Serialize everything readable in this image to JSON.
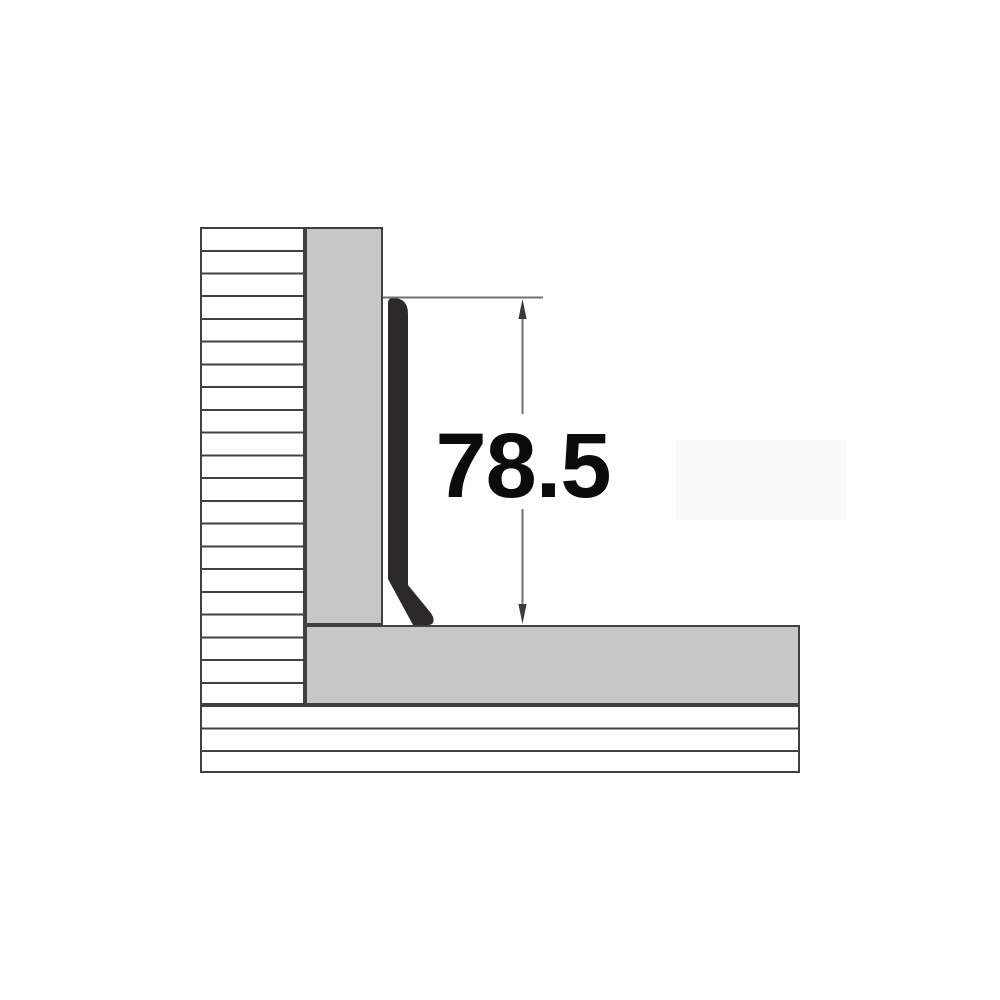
{
  "diagram": {
    "dimension_label": "78.5",
    "colors": {
      "background": "#ffffff",
      "fill_gray": "#c6c7c6",
      "profile_black": "#2b2a29",
      "outline": "#404040",
      "dimension_line": "#707070",
      "arrow": "#3a3a3a",
      "label_text": "#0b0b0b",
      "faint_box": "#fafafa"
    }
  }
}
